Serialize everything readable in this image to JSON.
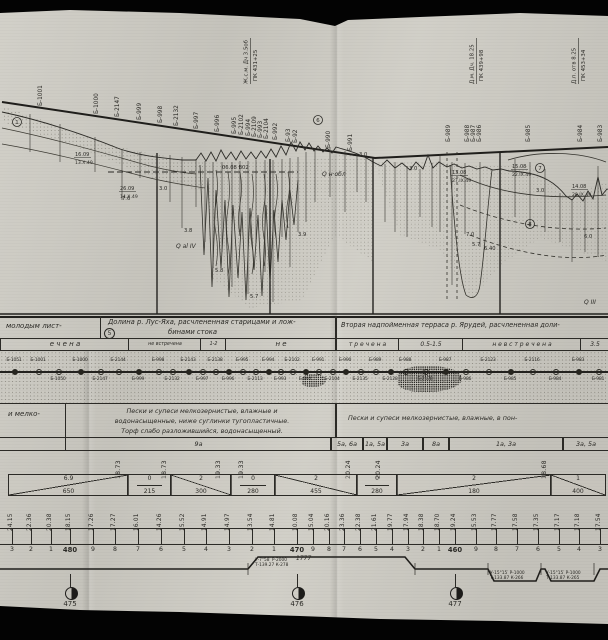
{
  "section": {
    "water_line_label": "06.08 В02",
    "borehole_labels": [
      {
        "x": 42,
        "t": "Б-1001"
      },
      {
        "x": 98,
        "t": "Б-1000"
      },
      {
        "x": 119,
        "t": "Б-2147"
      },
      {
        "x": 141,
        "t": "Б-999"
      },
      {
        "x": 162,
        "t": "Б-998"
      },
      {
        "x": 178,
        "t": "Б-2132"
      },
      {
        "x": 198,
        "t": "Б-997"
      },
      {
        "x": 219,
        "t": "Б-996"
      },
      {
        "x": 236,
        "t": "Б-995"
      },
      {
        "x": 243,
        "t": "Б-2102"
      },
      {
        "x": 250,
        "t": "Б-994"
      },
      {
        "x": 256,
        "t": "Б-2109"
      },
      {
        "x": 262,
        "t": "Б-993"
      },
      {
        "x": 268,
        "t": "Б-2104"
      },
      {
        "x": 277,
        "t": "Б-992"
      },
      {
        "x": 290,
        "t": "Б-93"
      },
      {
        "x": 297,
        "t": "Б-92"
      },
      {
        "x": 330,
        "t": "Б-990"
      },
      {
        "x": 352,
        "t": "Б-991"
      },
      {
        "x": 450,
        "t": "Б-989"
      },
      {
        "x": 469,
        "t": "Б-988"
      },
      {
        "x": 475,
        "t": "Б-987"
      },
      {
        "x": 481,
        "t": "Б-986"
      },
      {
        "x": 530,
        "t": "Б-985"
      },
      {
        "x": 582,
        "t": "Б-984"
      },
      {
        "x": 602,
        "t": "Б-983"
      }
    ],
    "structure_labels": [
      {
        "x": 250,
        "l1": "Ж.с.м. Дч 3.5об",
        "l2": "ПК 431+25"
      },
      {
        "x": 476,
        "l1": "Д.м. Дч. 18.25",
        "l2": "ПК 439+98"
      },
      {
        "x": 578,
        "l1": "Д.п. отв 8.25",
        "l2": "ПК 453+34"
      }
    ],
    "boreholes": [
      [
        30,
        114,
        152
      ],
      [
        60,
        124,
        162
      ],
      [
        95,
        137,
        172
      ],
      [
        122,
        149,
        200
      ],
      [
        140,
        152,
        178
      ],
      [
        157,
        154,
        186
      ],
      [
        170,
        155,
        202
      ],
      [
        182,
        157,
        228
      ],
      [
        196,
        159,
        207
      ],
      [
        205,
        161,
        242
      ],
      [
        213,
        162,
        268
      ],
      [
        222,
        162,
        252
      ],
      [
        232,
        162,
        287
      ],
      [
        240,
        161,
        232
      ],
      [
        248,
        161,
        294
      ],
      [
        256,
        160,
        242
      ],
      [
        265,
        160,
        272
      ],
      [
        273,
        160,
        302
      ],
      [
        282,
        159,
        237
      ],
      [
        290,
        158,
        267
      ],
      [
        298,
        157,
        232
      ],
      [
        306,
        152,
        222
      ],
      [
        315,
        148,
        202
      ],
      [
        330,
        147,
        197
      ],
      [
        345,
        151,
        212
      ],
      [
        357,
        154,
        192
      ],
      [
        366,
        157,
        202
      ],
      [
        385,
        164,
        222
      ],
      [
        395,
        162,
        232
      ],
      [
        407,
        166,
        237
      ],
      [
        420,
        169,
        217
      ],
      [
        432,
        163,
        227
      ],
      [
        440,
        154,
        232
      ],
      [
        452,
        162,
        285
      ],
      [
        465,
        163,
        234
      ],
      [
        480,
        162,
        247
      ],
      [
        515,
        159,
        217
      ],
      [
        530,
        162,
        227
      ],
      [
        545,
        169,
        232
      ],
      [
        560,
        193,
        242
      ],
      [
        572,
        199,
        262
      ],
      [
        585,
        196,
        252
      ],
      [
        598,
        166,
        257
      ]
    ],
    "depth_labels": [
      [
        157,
        190,
        "3.0"
      ],
      [
        120,
        200,
        "7.6"
      ],
      [
        182,
        232,
        "3.8"
      ],
      [
        213,
        272,
        "5.8"
      ],
      [
        248,
        298,
        "5.7"
      ],
      [
        296,
        236,
        "3.9"
      ],
      [
        357,
        156,
        "3.0"
      ],
      [
        407,
        170,
        "3.0"
      ],
      [
        464,
        236,
        "7.0"
      ],
      [
        470,
        246,
        "5.7"
      ],
      [
        482,
        250,
        "6.40"
      ],
      [
        534,
        192,
        "3.0"
      ],
      [
        582,
        238,
        "6.0"
      ]
    ],
    "date_notes": [
      [
        75,
        156,
        "16.09",
        "13.X.49"
      ],
      [
        120,
        190,
        "26.09",
        "14.X.49"
      ],
      [
        452,
        174,
        "13.08",
        "27.IX.49"
      ],
      [
        512,
        168,
        "15.08",
        "22.IX.49"
      ],
      [
        572,
        188,
        "14.08",
        "20.IX.49"
      ]
    ],
    "circled": [
      [
        17,
        122,
        "1"
      ],
      [
        318,
        120,
        "6"
      ],
      [
        540,
        168,
        "7"
      ],
      [
        530,
        224,
        "8"
      ]
    ],
    "strat_labels": [
      [
        176,
        248,
        "Q al IV"
      ],
      [
        322,
        176,
        "Q н·обл"
      ],
      [
        584,
        304,
        "Q III"
      ]
    ]
  },
  "bands": {
    "row1": {
      "left": "молодым лист-",
      "center_l1": "Долина р. Лус-Яха, расчлененная старицами и лож-",
      "center_l2": "бинами стока",
      "center_badge": "5",
      "right": "Вторая надпойменная терраса р. Ярудей, расчлененная доли-"
    },
    "permafrost": [
      {
        "x": 0,
        "w": 128,
        "t": "е ч е н а",
        "fs": 7
      },
      {
        "x": 128,
        "w": 72,
        "t": "не встречена",
        "fs": 4.8
      },
      {
        "x": 200,
        "w": 25,
        "t": "1-2",
        "fs": 4.8
      },
      {
        "x": 225,
        "w": 110,
        "t": "н е",
        "fs": 7
      },
      {
        "x": 335,
        "w": 63,
        "t": "т р е ч е н а",
        "fs": 6
      },
      {
        "x": 398,
        "w": 64,
        "t": "0.5-1.5",
        "fs": 6
      },
      {
        "x": 462,
        "w": 118,
        "t": "н е   в с т р е ч е н а",
        "fs": 6
      },
      {
        "x": 580,
        "w": 28,
        "t": "3.5",
        "fs": 6
      }
    ],
    "soil": {
      "left": "и мелко-",
      "center_l1": "Пески и супеси мелкозернистые, влажные и",
      "center_l2": "водонасыщенные, ниже суглинки тугопластичные.",
      "center_l3": "Торф слабо разложившийся, водонасыщенный.",
      "right": "Пески и супеси мелкозернистые, влажные, в пон-"
    },
    "zones": [
      {
        "x": 65,
        "w": 265,
        "t": "9а"
      },
      {
        "x": 330,
        "w": 32,
        "t": "5а, 6а"
      },
      {
        "x": 362,
        "w": 24,
        "t": "1а, 5а"
      },
      {
        "x": 386,
        "w": 36,
        "t": "3а"
      },
      {
        "x": 422,
        "w": 26,
        "t": "8а"
      },
      {
        "x": 448,
        "w": 114,
        "t": "1а, 3а"
      },
      {
        "x": 562,
        "w": 46,
        "t": "3а, 5а"
      }
    ],
    "elev_top": [
      {
        "x": 122,
        "v": "18.73"
      },
      {
        "x": 168,
        "v": "18.73"
      },
      {
        "x": 222,
        "v": "19.33"
      },
      {
        "x": 245,
        "v": "19.33"
      },
      {
        "x": 352,
        "v": "20.24"
      },
      {
        "x": 382,
        "v": "20.24"
      },
      {
        "x": 548,
        "v": "18.68"
      }
    ],
    "gradients": [
      {
        "x": 8,
        "w": 119,
        "grade": "6.9",
        "len": "650",
        "dir": 1
      },
      {
        "x": 127,
        "w": 43,
        "grade": "0",
        "len": "215",
        "dir": 0
      },
      {
        "x": 170,
        "w": 60,
        "grade": "2",
        "len": "300",
        "dir": -1
      },
      {
        "x": 230,
        "w": 44,
        "grade": "0",
        "len": "280",
        "dir": 0
      },
      {
        "x": 274,
        "w": 82,
        "grade": "2",
        "len": "455",
        "dir": -1
      },
      {
        "x": 356,
        "w": 40,
        "grade": "0",
        "len": "280",
        "dir": 0
      },
      {
        "x": 396,
        "w": 154,
        "grade": "2",
        "len": "180",
        "dir": 1
      },
      {
        "x": 550,
        "w": 54,
        "grade": "1",
        "len": "400",
        "dir": -1
      }
    ],
    "picket_x": [
      12,
      31,
      51,
      70,
      93,
      115,
      138,
      161,
      184,
      206,
      229,
      252,
      274,
      297,
      313,
      329,
      344,
      360,
      376,
      392,
      408,
      423,
      439,
      455,
      476,
      496,
      517,
      538,
      559,
      579,
      600
    ],
    "elevations": [
      "24.15",
      "22.36",
      "20.38",
      "18.15",
      "17.26",
      "17.27",
      "16.01",
      "14.26",
      "15.52",
      "14.91",
      "14.97",
      "13.54",
      "14.81",
      "10.08",
      "15.04",
      "20.16",
      "23.36",
      "22.38",
      "21.61",
      "19.77",
      "17.94",
      "18.38",
      "18.70",
      "19.24",
      "15.53",
      "17.77",
      "17.58",
      "17.35",
      "17.17",
      "17.18",
      "17.54"
    ],
    "pickets": [
      "3",
      "2",
      "1",
      "480",
      "9",
      "8",
      "7",
      "6",
      "5",
      "4",
      "3",
      "2",
      "1",
      "470",
      "9",
      "8",
      "7",
      "6",
      "5",
      "4",
      "3",
      "2",
      "1",
      "460",
      "9",
      "8",
      "7",
      "6",
      "5",
      "4",
      "3"
    ],
    "plan_distance": "1777",
    "curves": [
      {
        "x": 255,
        "y": 558,
        "l1": "У-7°58′  Р-2000",
        "l2": "Т-139.27  К-278"
      },
      {
        "x": 490,
        "y": 571,
        "l1": "У-15°15′ Р-1000",
        "l2": "Т-133.87 К-266"
      },
      {
        "x": 546,
        "y": 571,
        "l1": "У-15°15′ Р-1000",
        "l2": "Т-133.87 К-265"
      }
    ],
    "km_posts": [
      {
        "x": 70,
        "label": "475"
      },
      {
        "x": 297,
        "label": "476"
      },
      {
        "x": 455,
        "label": "477"
      }
    ]
  },
  "map_band": {
    "labels": [
      {
        "x": 14,
        "side": "a",
        "t": "Б-1051"
      },
      {
        "x": 38,
        "side": "a",
        "t": "Б-1001"
      },
      {
        "x": 58,
        "side": "b",
        "t": "Б-1050"
      },
      {
        "x": 80,
        "side": "a",
        "t": "Б-1000"
      },
      {
        "x": 100,
        "side": "b",
        "t": "Б-2147"
      },
      {
        "x": 118,
        "side": "a",
        "t": "Б-2144"
      },
      {
        "x": 138,
        "side": "b",
        "t": "Б-999"
      },
      {
        "x": 158,
        "side": "a",
        "t": "Б-998"
      },
      {
        "x": 172,
        "side": "b",
        "t": "Б-2132"
      },
      {
        "x": 188,
        "side": "a",
        "t": "Б-2143"
      },
      {
        "x": 202,
        "side": "b",
        "t": "Б-997"
      },
      {
        "x": 215,
        "side": "a",
        "t": "Б-2138"
      },
      {
        "x": 228,
        "side": "b",
        "t": "Б-996"
      },
      {
        "x": 242,
        "side": "a",
        "t": "Б-995"
      },
      {
        "x": 255,
        "side": "b",
        "t": "Б-2113"
      },
      {
        "x": 268,
        "side": "a",
        "t": "Б-994"
      },
      {
        "x": 280,
        "side": "b",
        "t": "Б-993"
      },
      {
        "x": 292,
        "side": "a",
        "t": "Б-2102"
      },
      {
        "x": 305,
        "side": "b",
        "t": "Б-992"
      },
      {
        "x": 318,
        "side": "a",
        "t": "Б-991"
      },
      {
        "x": 332,
        "side": "b",
        "t": "Б-2104"
      },
      {
        "x": 345,
        "side": "a",
        "t": "Б-990"
      },
      {
        "x": 360,
        "side": "b",
        "t": "Б-2135"
      },
      {
        "x": 375,
        "side": "a",
        "t": "Б-989"
      },
      {
        "x": 390,
        "side": "b",
        "t": "Б-2128"
      },
      {
        "x": 405,
        "side": "a",
        "t": "Б-988"
      },
      {
        "x": 425,
        "side": "b",
        "t": "Б-2178"
      },
      {
        "x": 445,
        "side": "a",
        "t": "Б-987"
      },
      {
        "x": 465,
        "side": "b",
        "t": "Б-986"
      },
      {
        "x": 488,
        "side": "a",
        "t": "Б-2123"
      },
      {
        "x": 510,
        "side": "b",
        "t": "Б-985"
      },
      {
        "x": 532,
        "side": "a",
        "t": "Б-2116"
      },
      {
        "x": 555,
        "side": "b",
        "t": "Б-984"
      },
      {
        "x": 578,
        "side": "a",
        "t": "Б-983"
      },
      {
        "x": 598,
        "side": "b",
        "t": "Б-981"
      }
    ]
  }
}
